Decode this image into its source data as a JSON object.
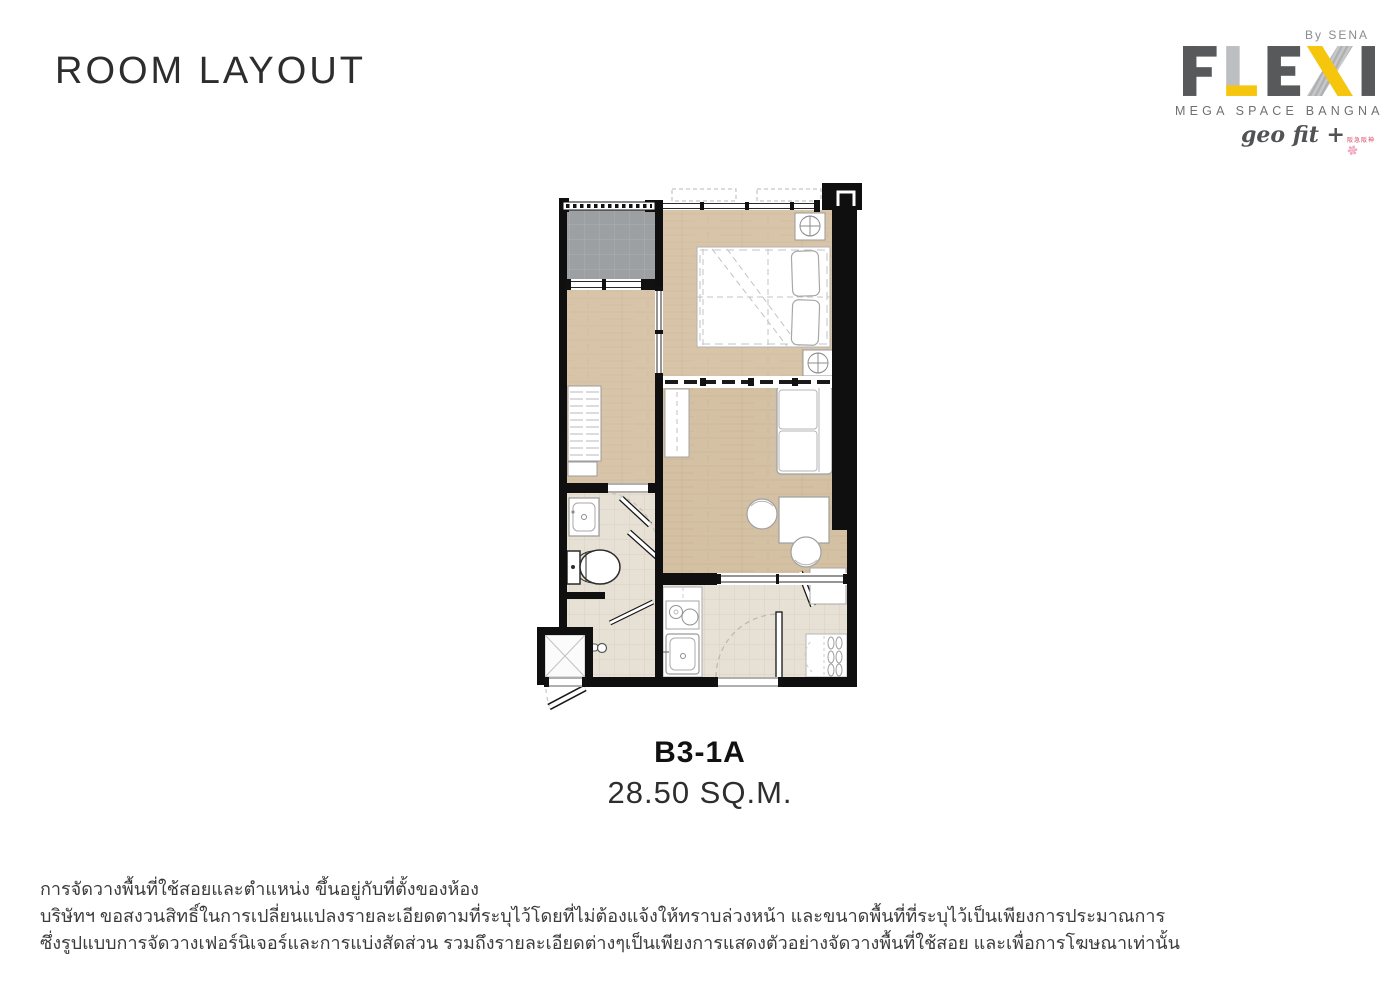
{
  "header": {
    "title": "ROOM LAYOUT"
  },
  "logo": {
    "by": "By SENA",
    "name": "FLEXI",
    "subtitle": "MEGA SPACE BANGNA",
    "tagline": "geo fit +",
    "tagline_note": "阪急阪神",
    "spark_icon": "✽"
  },
  "unit": {
    "code": "B3-1A",
    "area": "28.50 SQ.M."
  },
  "disclaimer": {
    "line1": "การจัดวางพื้นที่ใช้สอยและตำแหน่ง ขึ้นอยู่กับที่ตั้งของห้อง",
    "line2": "บริษัทฯ ขอสงวนสิทธิ์ในการเปลี่ยนแปลงรายละเอียดตามที่ระบุไว้โดยที่ไม่ต้องแจ้งให้ทราบล่วงหน้า และขนาดพื้นที่ที่ระบุไว้เป็นเพียงการประมาณการ",
    "line3": "ซึ่งรูปแบบการจัดวางเฟอร์นิเจอร์และการแบ่งสัดส่วน รวมถึงรายละเอียดต่างๆเป็นเพียงการแสดงตัวอย่างจัดวางพื้นที่ใช้สอย และเพื่อการโฆษณาเท่านั้น"
  },
  "floor_plan": {
    "rooms": [
      "balcony",
      "bedroom",
      "multipurpose-room",
      "living-area",
      "bathroom",
      "shower",
      "kitchen",
      "entry-hall",
      "service-ledge"
    ],
    "fixtures": [
      "double-bed",
      "wardrobe",
      "tv-console",
      "sofa",
      "desk",
      "chairs",
      "wash-basin",
      "toilet",
      "shower-head",
      "towel-rail",
      "stove",
      "kitchen-sink",
      "shoe-cabinet",
      "shoe-rack",
      "ceiling-fan-units",
      "sliding-partition",
      "entrance-door"
    ]
  },
  "colors": {
    "accent_yellow": "#f6c50d",
    "logo_dark_gray": "#58595b",
    "logo_light_gray": "#bcbec0",
    "wall_black": "#0f0f0f",
    "wood_floor": "#d8c5a9",
    "balcony_gray": "#9da0a2",
    "tile_beige": "#e7e0d4",
    "brand_pink": "#f0a8c2",
    "brand_red": "#d9485f"
  }
}
